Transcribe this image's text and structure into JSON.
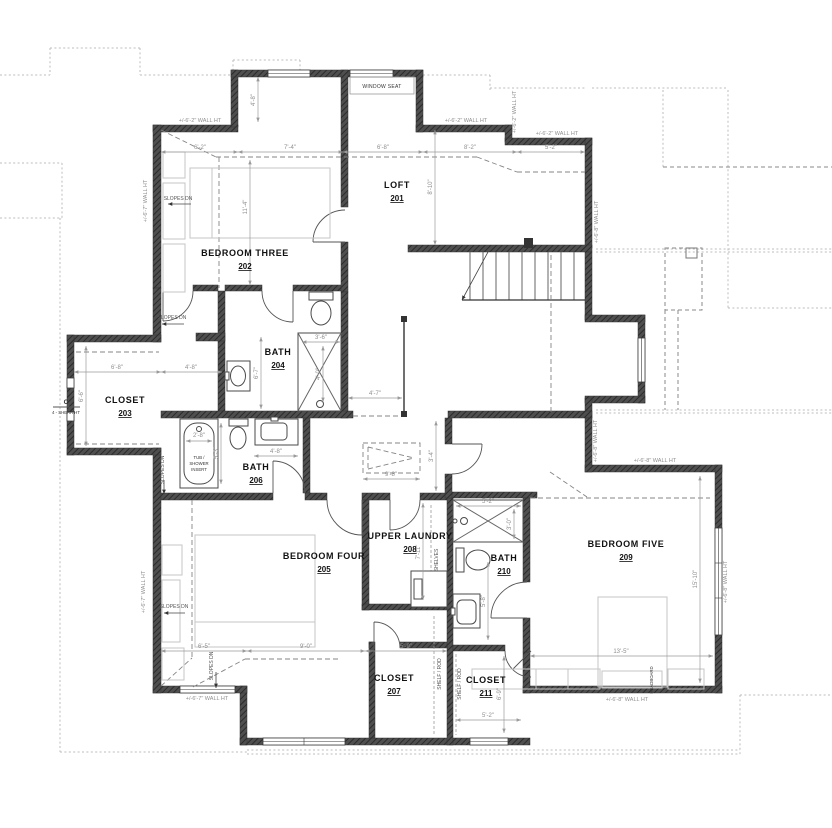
{
  "sheet": {
    "background": "#ffffff",
    "type": "second floor plan"
  },
  "colors": {
    "wall_fill": "#4f4f4f",
    "dimension_text": "#8f8f8f",
    "room_label": "#111111",
    "roof_outline": "#bdbdbd",
    "ceiling_break_line": "#848484",
    "fixture_outline": "#4a4a4a",
    "furniture_outline": "#c5c5c5"
  },
  "rooms": [
    {
      "name": "LOFT",
      "number": "201"
    },
    {
      "name": "BEDROOM THREE",
      "number": "202"
    },
    {
      "name": "CLOSET",
      "number": "203"
    },
    {
      "name": "BATH",
      "number": "204"
    },
    {
      "name": "BEDROOM FOUR",
      "number": "205"
    },
    {
      "name": "BATH",
      "number": "206"
    },
    {
      "name": "CLOSET",
      "number": "207"
    },
    {
      "name": "UPPER LAUNDRY",
      "number": "208"
    },
    {
      "name": "BEDROOM FIVE",
      "number": "209"
    },
    {
      "name": "BATH",
      "number": "210"
    },
    {
      "name": "CLOSET",
      "number": "211"
    }
  ],
  "wall_heights": {
    "h62": "+/-6'-2\" WALL HT",
    "h67": "+/-6'-7\" WALL HT",
    "h68": "+/-6'-8\" WALL HT"
  },
  "dimensions": {
    "t1": "6'-2\"",
    "t2": "7'-4\"",
    "t3": "6'-8\"",
    "t4": "8'-2\"",
    "t5": "5'-2\"",
    "br3v": "4'-8\"",
    "br3h": "11'-4\"",
    "loftv": "8'-10\"",
    "c203a": "6'-8\"",
    "c203b": "4'-8\"",
    "c203h": "6'-6\"",
    "b204h": "6'-7\"",
    "s204w": "3'-6\"",
    "s204h": "4'-0\"",
    "hallw": "4'-7\"",
    "tubw": "2'-8\"",
    "tubh": "5'-3\"",
    "b206w": "4'-8\"",
    "attw": "9'-8\"",
    "atth": "3'-4\"",
    "b4a": "6'-5\"",
    "b4b": "9'-0\"",
    "c207w": "5'-9\"",
    "launh": "7'-11\"",
    "s210w": "5'-2\"",
    "s210h": "3'-0\"",
    "b210h": "5'-8\"",
    "c211h": "6'-9\"",
    "c211w": "5'-2\"",
    "br5w": "13'-5\"",
    "br5h": "15'-10\""
  },
  "annotations": {
    "window_seat": "WINDOW SEAT",
    "slopes_dn": "SLOPES DN",
    "shelves": "SHELVES",
    "shelf_rod": "SHELF / ROD",
    "tub_l1": "TUB /",
    "tub_l2": "SHOWER",
    "tub_l3": "INSERT",
    "headboard": "HEADBOARD",
    "section_mark": "C",
    "section_ref": "4 - SHEAR HT"
  }
}
